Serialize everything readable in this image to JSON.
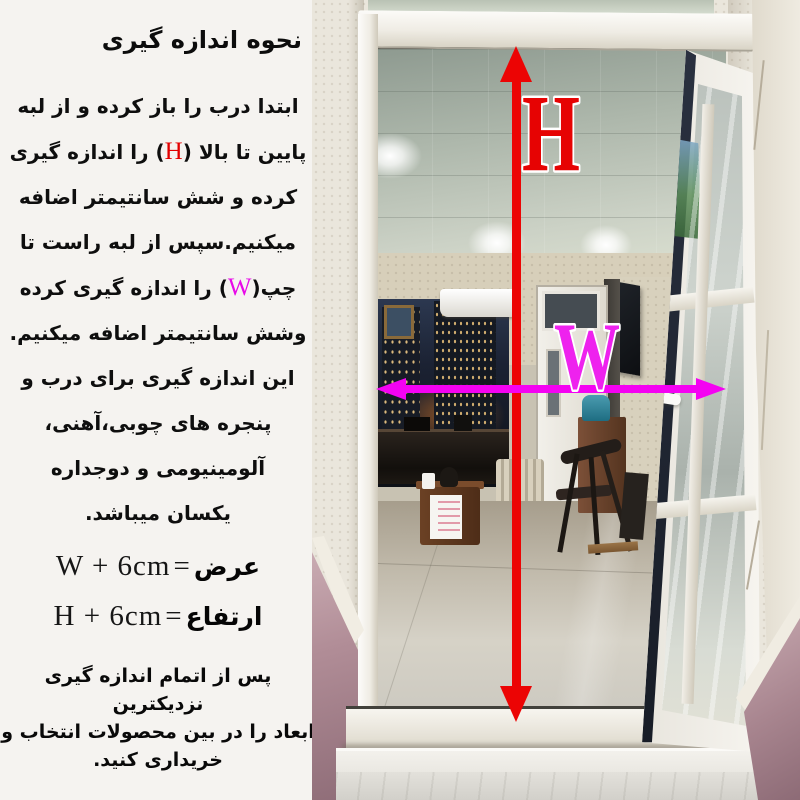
{
  "title": "نحوه اندازه گیری",
  "instructions": {
    "l1": "ابتدا درب را باز کرده و از لبه",
    "l2a": "پایین تا بالا (",
    "l2b": "H",
    "l2c": ") را اندازه گیری",
    "l3": "کرده و شش سانتیمتر اضافه",
    "l4": "میکنیم.سپس از لبه راست تا",
    "l5a": "چپ(",
    "l5b": "W",
    "l5c": ") را اندازه گیری کرده",
    "l6": "وشش سانتیمتر اضافه میکنیم.",
    "l7": "این اندازه گیری برای درب و",
    "l8": "پنجره های چوبی،آهنی،",
    "l9": "آلومینیومی و دوجداره",
    "l10": "یکسان میباشد."
  },
  "formulas": {
    "width": {
      "expr": "W + 6cm",
      "eq": "=",
      "label": "عرض"
    },
    "height": {
      "expr": "H + 6cm",
      "eq": "=",
      "label": "ارتفاع"
    }
  },
  "footer": {
    "l1": "پس از اتمام اندازه گیری نزدیکترین",
    "l2": "ابعاد را در بین محصولات انتخاب و",
    "l3": "خریداری کنید."
  },
  "photo": {
    "height_label": "H",
    "width_label": "W",
    "colors": {
      "height_arrow": "#ec0404",
      "width_arrow": "#f402f2",
      "height_letter": "#e60303",
      "width_letter": "#ee22ee",
      "frame_white": "#f5f3ee",
      "wall": "#eae6dc",
      "pink_tile": "#ab8791",
      "marble_step": "#e9e7e2"
    }
  }
}
